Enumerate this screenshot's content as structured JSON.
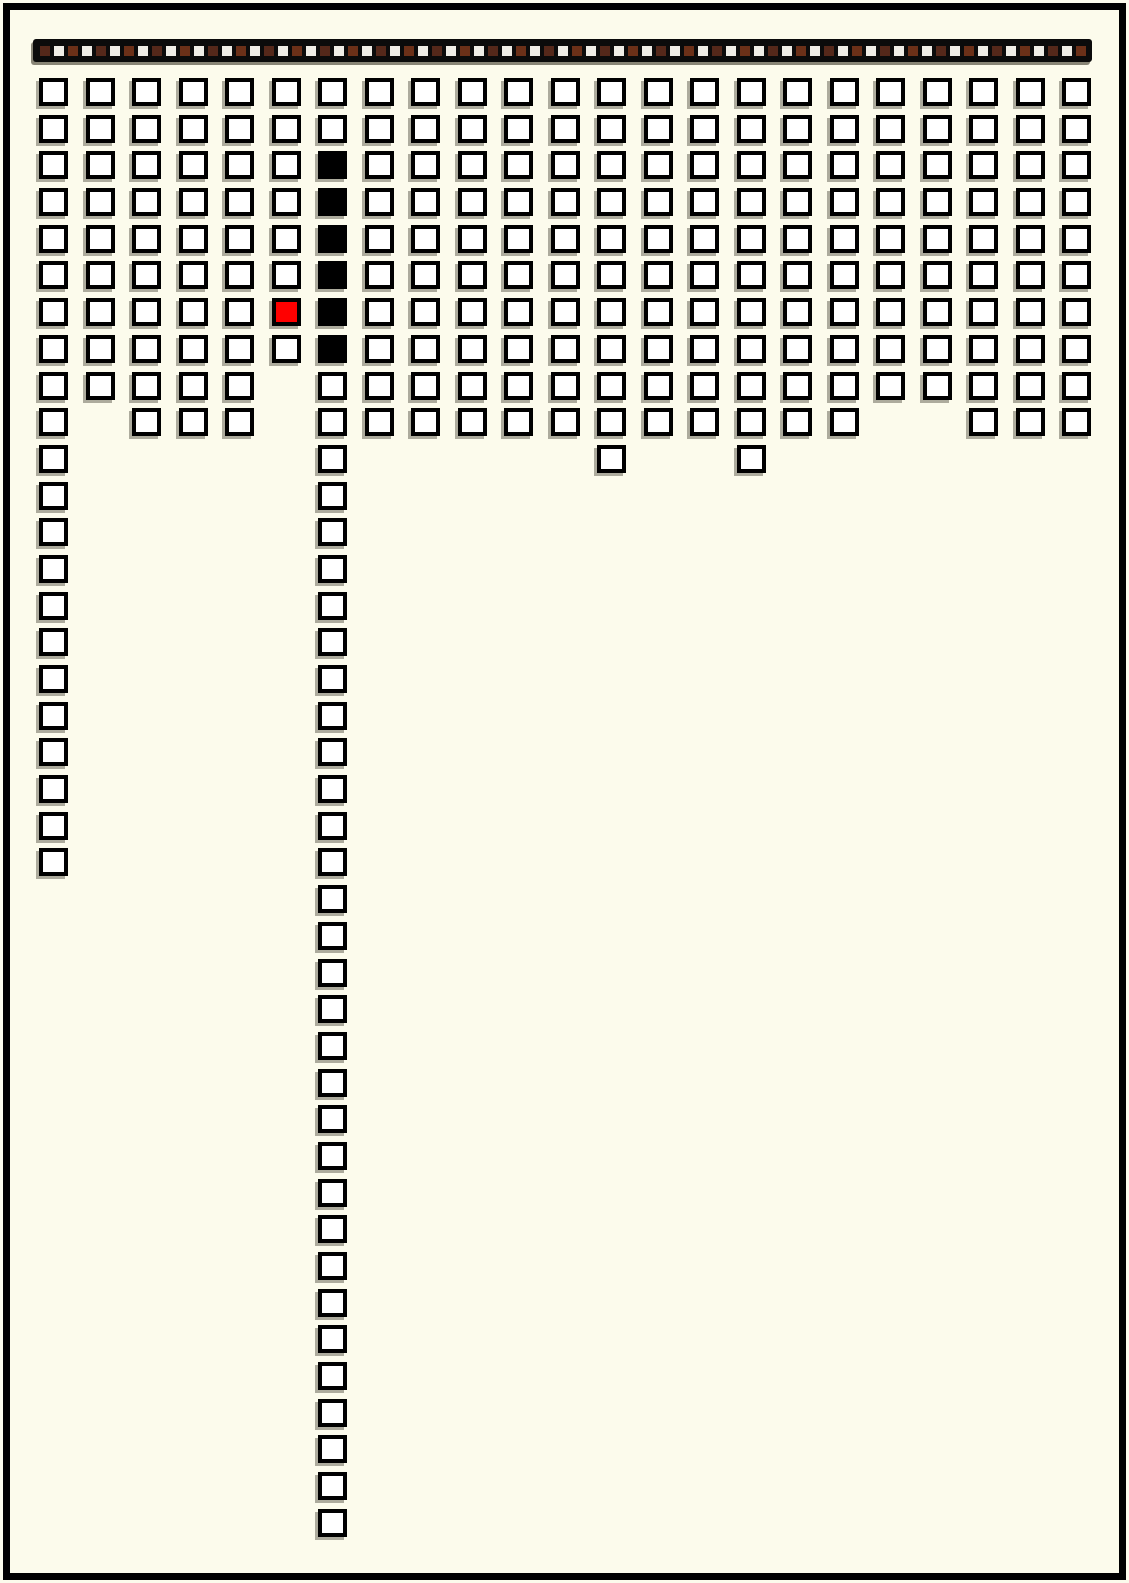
{
  "page": {
    "description": "hand-drawn style page with a dark film-strip ruler on top and 23 hanging columns of checkbox squares",
    "background_color": "#FCFBEC",
    "frame_color": "#000000"
  },
  "palette": {
    "cell_fill": "#FFFFFF",
    "cell_border": "#000000",
    "cell_shadow": "#6C6A5D",
    "red_cell": "#FF0000",
    "black_cell": "#000000",
    "strip_bar": "#0B0B0B",
    "strip_brown": "#54281A",
    "strip_brown_alt": "#6B3018",
    "strip_white": "#EFEDE6"
  },
  "top_strip": {
    "cell_count": 75,
    "pattern": "alternating brown and white small squares starting with brown"
  },
  "grid": {
    "column_count": 23,
    "columns": [
      {
        "index": 1,
        "count": 22
      },
      {
        "index": 2,
        "count": 9
      },
      {
        "index": 3,
        "count": 10
      },
      {
        "index": 4,
        "count": 10
      },
      {
        "index": 5,
        "count": 10
      },
      {
        "index": 6,
        "count": 8,
        "red_cells": [
          7
        ]
      },
      {
        "index": 7,
        "count": 40,
        "black_cells": [
          3,
          4,
          5,
          6,
          7,
          8
        ]
      },
      {
        "index": 8,
        "count": 10
      },
      {
        "index": 9,
        "count": 10
      },
      {
        "index": 10,
        "count": 10
      },
      {
        "index": 11,
        "count": 10
      },
      {
        "index": 12,
        "count": 10
      },
      {
        "index": 13,
        "count": 11
      },
      {
        "index": 14,
        "count": 10
      },
      {
        "index": 15,
        "count": 10
      },
      {
        "index": 16,
        "count": 11
      },
      {
        "index": 17,
        "count": 10
      },
      {
        "index": 18,
        "count": 10
      },
      {
        "index": 19,
        "count": 9
      },
      {
        "index": 20,
        "count": 9
      },
      {
        "index": 21,
        "count": 10
      },
      {
        "index": 22,
        "count": 10
      },
      {
        "index": 23,
        "count": 10
      }
    ]
  }
}
